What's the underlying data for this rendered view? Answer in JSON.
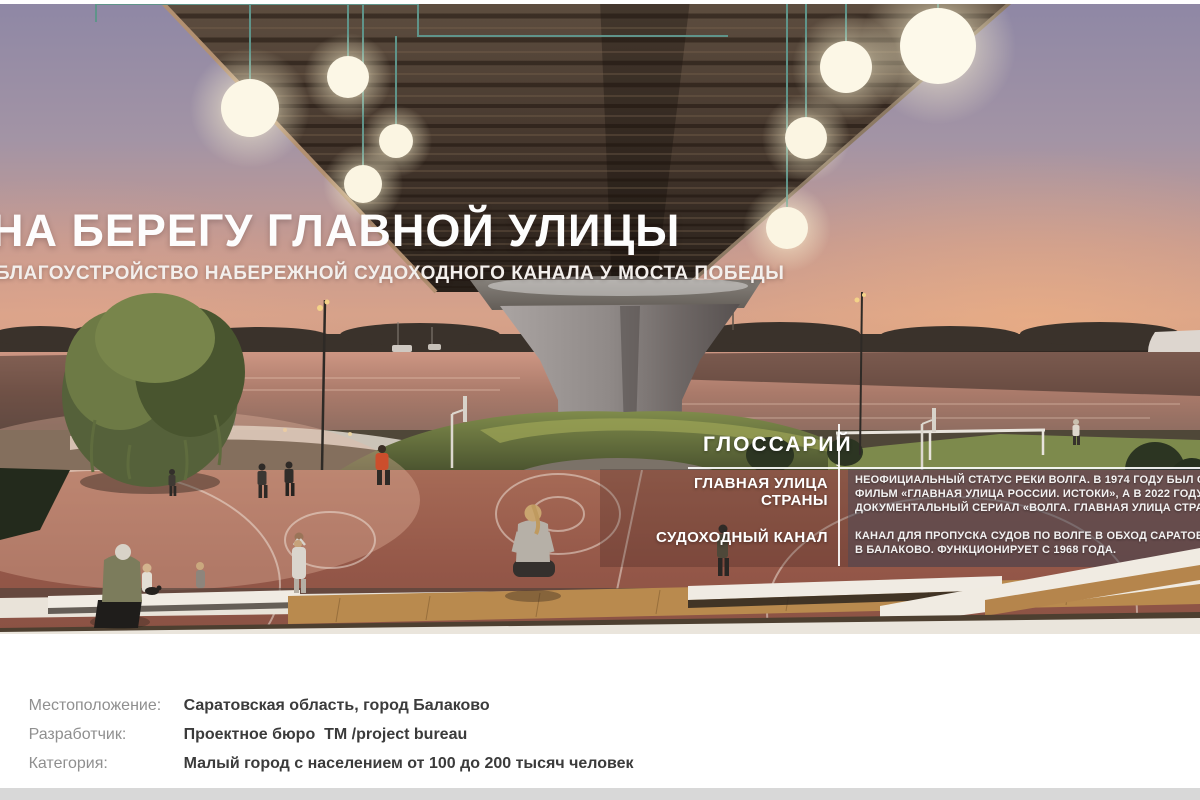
{
  "hero": {
    "title": "НА БЕРЕГУ ГЛАВНОЙ УЛИЦЫ",
    "subtitle": "БЛАГОУСТРОЙСТВО НАБЕРЕЖНОЙ СУДОХОДНОГО КАНАЛА У МОСТА ПОБЕДЫ"
  },
  "glossary": {
    "heading": "ГЛОССАРИЙ",
    "entries": [
      {
        "term_lines": [
          "ГЛАВНАЯ УЛИЦА",
          "СТРАНЫ"
        ],
        "definition_lines": [
          "НЕОФИЦИАЛЬНЫЙ СТАТУС РЕКИ ВОЛГА. В 1974 ГОДУ БЫЛ СНЯТ",
          "ФИЛЬМ «ГЛАВНАЯ УЛИЦА РОССИИ. ИСТОКИ», А В 2022 ГОДУ ВЫШЕЛ",
          "ДОКУМЕНТАЛЬНЫЙ СЕРИАЛ «ВОЛГА. ГЛАВНАЯ УЛИЦА СТРАНЫ»"
        ]
      },
      {
        "term_lines": [
          "СУДОХОДНЫЙ КАНАЛ"
        ],
        "definition_lines": [
          "КАНАЛ ДЛЯ ПРОПУСКА СУДОВ ПО ВОЛГЕ В ОБХОД САРАТОВСКОЙ",
          "В БАЛАКОВО. ФУНКЦИОНИРУЕТ С 1968 ГОДА."
        ]
      }
    ]
  },
  "footer": {
    "fields": [
      {
        "label": "Местоположение:",
        "value": "Саратовская область, город Балаково"
      },
      {
        "label": "Разработчик:",
        "value": "Проектное бюро  ТМ /project bureau"
      },
      {
        "label": "Категория:",
        "value": "Малый город с населением от 100 до 200 тысяч человек"
      }
    ],
    "logos": {
      "minstroy": {
        "title_line1": "МИНСТРОЙ",
        "title_line2": "РОССИИ",
        "caption_lines": [
          "МИНИСТЕРСТВО СТРОИТЕЛЬСТВА",
          "И ЖИЛИЩНО-КОММУНАЛЬНОГО",
          "ХОЗЯЙСТВА РОССИЙСКОЙ ФЕДЕРАЦИИ"
        ]
      },
      "contest": {
        "light_lines": [
          "ВСЕРОССИЙСКИЙ КОНКУРС",
          "ЛУЧШИХ ПРОЕКТОВ"
        ],
        "bold_lines": [
          "СОЗДАНИЯ КОМФОРТНОЙ",
          "ГОРОДСКОЙ СРЕДЫ"
        ]
      },
      "balakovo": {
        "caption_lines": [
          "АДМИНИСТРАЦИЯ",
          "БАЛАКОВСКОГО РАЙОНА"
        ]
      },
      "tm": {
        "mark": "ТМ",
        "slash": "/",
        "sub": "project bureau"
      }
    }
  },
  "colors": {
    "contest_green": "#35b27c",
    "contest_teal": "#1f9e8c",
    "balakovo_red": "#d23b2e",
    "balakovo_blue": "#2a6ab0",
    "minstroy_text": "#464646",
    "tm_black": "#121212"
  }
}
